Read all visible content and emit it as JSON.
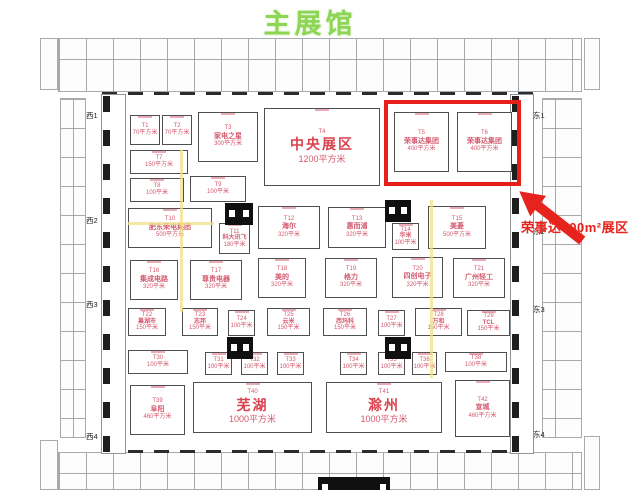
{
  "title": "主展馆",
  "callout": {
    "text": "荣事达800m²展区"
  },
  "colors": {
    "highlight_red": "#e71f19",
    "booth_text_pink": "#d4596e",
    "title_green": "#8ed455"
  },
  "highlighted_booths": [
    "T5",
    "T6"
  ],
  "gates": [
    {
      "label": "西1",
      "x": 86,
      "y": 110
    },
    {
      "label": "西2",
      "x": 86,
      "y": 215
    },
    {
      "label": "西3",
      "x": 86,
      "y": 299
    },
    {
      "label": "西4",
      "x": 86,
      "y": 431
    },
    {
      "label": "东1",
      "x": 533,
      "y": 110
    },
    {
      "label": "东2",
      "x": 533,
      "y": 226
    },
    {
      "label": "东3",
      "x": 533,
      "y": 304
    },
    {
      "label": "东4",
      "x": 533,
      "y": 429
    }
  ],
  "booths": [
    {
      "id": "T1",
      "name": "",
      "area": "70平方米",
      "x": 130,
      "y": 115,
      "w": 30,
      "h": 30,
      "size": "sm"
    },
    {
      "id": "T2",
      "name": "",
      "area": "70平方米",
      "x": 162,
      "y": 115,
      "w": 30,
      "h": 30,
      "size": "sm"
    },
    {
      "id": "T3",
      "name": "家电之星",
      "area": "300平方米",
      "x": 198,
      "y": 112,
      "w": 60,
      "h": 50,
      "size": "md"
    },
    {
      "id": "T4",
      "name": "中央展区",
      "area": "1200平方米",
      "x": 264,
      "y": 108,
      "w": 116,
      "h": 78,
      "size": "lg"
    },
    {
      "id": "T5",
      "name": "荣事达集团",
      "area": "400平方米",
      "x": 394,
      "y": 112,
      "w": 55,
      "h": 60,
      "size": "md"
    },
    {
      "id": "T6",
      "name": "荣事达集团",
      "area": "400平方米",
      "x": 457,
      "y": 112,
      "w": 55,
      "h": 60,
      "size": "md"
    },
    {
      "id": "T7",
      "name": "",
      "area": "150平方米",
      "x": 130,
      "y": 150,
      "w": 58,
      "h": 24,
      "size": "sm"
    },
    {
      "id": "T8",
      "name": "",
      "area": "100平米",
      "x": 130,
      "y": 178,
      "w": 54,
      "h": 24,
      "size": "sm"
    },
    {
      "id": "T9",
      "name": "",
      "area": "100平米",
      "x": 190,
      "y": 176,
      "w": 56,
      "h": 26,
      "size": "sm"
    },
    {
      "id": "T10",
      "name": "肥东荣电集团",
      "area": "500平方米",
      "x": 128,
      "y": 208,
      "w": 84,
      "h": 40,
      "size": "md"
    },
    {
      "id": "T11",
      "name": "科大讯飞",
      "area": "180平米",
      "x": 219,
      "y": 223,
      "w": 31,
      "h": 31,
      "size": "sm"
    },
    {
      "id": "T12",
      "name": "海尔",
      "area": "320平米",
      "x": 258,
      "y": 206,
      "w": 62,
      "h": 43,
      "size": "md"
    },
    {
      "id": "T13",
      "name": "惠而浦",
      "area": "320平米",
      "x": 328,
      "y": 207,
      "w": 58,
      "h": 41,
      "size": "md"
    },
    {
      "id": "T14",
      "name": "华米",
      "area": "100平米",
      "x": 392,
      "y": 223,
      "w": 27,
      "h": 27,
      "size": "sm"
    },
    {
      "id": "T15",
      "name": "美菱",
      "area": "500平方米",
      "x": 428,
      "y": 206,
      "w": 58,
      "h": 43,
      "size": "md"
    },
    {
      "id": "T16",
      "name": "集成电路",
      "area": "320平米",
      "x": 130,
      "y": 260,
      "w": 48,
      "h": 40,
      "size": "md"
    },
    {
      "id": "T17",
      "name": "尊贵电器",
      "area": "320平米",
      "x": 190,
      "y": 260,
      "w": 52,
      "h": 40,
      "size": "md"
    },
    {
      "id": "T18",
      "name": "美的",
      "area": "320平米",
      "x": 258,
      "y": 258,
      "w": 48,
      "h": 40,
      "size": "md"
    },
    {
      "id": "T19",
      "name": "格力",
      "area": "320平米",
      "x": 325,
      "y": 258,
      "w": 52,
      "h": 40,
      "size": "md"
    },
    {
      "id": "T20",
      "name": "四创电子",
      "area": "320平米",
      "x": 392,
      "y": 257,
      "w": 51,
      "h": 41,
      "size": "md"
    },
    {
      "id": "T21",
      "name": "广州轻工",
      "area": "320平米",
      "x": 453,
      "y": 258,
      "w": 52,
      "h": 40,
      "size": "md"
    },
    {
      "id": "T22",
      "name": "巢湖市",
      "area": "150平米",
      "x": 128,
      "y": 308,
      "w": 38,
      "h": 28,
      "size": "sm"
    },
    {
      "id": "T23",
      "name": "志邦",
      "area": "150平米",
      "x": 182,
      "y": 308,
      "w": 36,
      "h": 28,
      "size": "sm"
    },
    {
      "id": "T24",
      "name": "",
      "area": "100平米",
      "x": 228,
      "y": 310,
      "w": 27,
      "h": 26,
      "size": "sm"
    },
    {
      "id": "T25",
      "name": "云米",
      "area": "150平米",
      "x": 267,
      "y": 308,
      "w": 43,
      "h": 28,
      "size": "sm"
    },
    {
      "id": "T26",
      "name": "西玛科",
      "area": "150平米",
      "x": 323,
      "y": 308,
      "w": 44,
      "h": 28,
      "size": "sm"
    },
    {
      "id": "T27",
      "name": "",
      "area": "100平米",
      "x": 378,
      "y": 310,
      "w": 27,
      "h": 26,
      "size": "sm"
    },
    {
      "id": "T28",
      "name": "万和",
      "area": "150平米",
      "x": 415,
      "y": 308,
      "w": 47,
      "h": 28,
      "size": "sm"
    },
    {
      "id": "T29",
      "name": "TCL",
      "area": "150平米",
      "x": 467,
      "y": 310,
      "w": 43,
      "h": 26,
      "size": "sm"
    },
    {
      "id": "T30",
      "name": "",
      "area": "100平米",
      "x": 128,
      "y": 350,
      "w": 60,
      "h": 24,
      "size": "sm"
    },
    {
      "id": "T31",
      "name": "",
      "area": "100平米",
      "x": 205,
      "y": 352,
      "w": 27,
      "h": 23,
      "size": "sm"
    },
    {
      "id": "T32",
      "name": "",
      "area": "100平米",
      "x": 241,
      "y": 352,
      "w": 27,
      "h": 23,
      "size": "sm"
    },
    {
      "id": "T33",
      "name": "",
      "area": "100平米",
      "x": 277,
      "y": 352,
      "w": 27,
      "h": 23,
      "size": "sm"
    },
    {
      "id": "T34",
      "name": "",
      "area": "100平米",
      "x": 340,
      "y": 352,
      "w": 27,
      "h": 23,
      "size": "sm"
    },
    {
      "id": "T35",
      "name": "",
      "area": "100平米",
      "x": 378,
      "y": 352,
      "w": 27,
      "h": 23,
      "size": "sm"
    },
    {
      "id": "T36",
      "name": "",
      "area": "100平米",
      "x": 412,
      "y": 352,
      "w": 25,
      "h": 23,
      "size": "sm"
    },
    {
      "id": "T38",
      "name": "",
      "area": "100平米",
      "x": 445,
      "y": 352,
      "w": 62,
      "h": 20,
      "size": "sm"
    },
    {
      "id": "T39",
      "name": "阜阳",
      "area": "460平方米",
      "x": 130,
      "y": 385,
      "w": 55,
      "h": 50,
      "size": "md"
    },
    {
      "id": "T40",
      "name": "芜湖",
      "area": "1000平方米",
      "x": 193,
      "y": 382,
      "w": 119,
      "h": 51,
      "size": "lg"
    },
    {
      "id": "T41",
      "name": "滁州",
      "area": "1000平方米",
      "x": 326,
      "y": 382,
      "w": 116,
      "h": 51,
      "size": "lg"
    },
    {
      "id": "T42",
      "name": "宣城",
      "area": "460平方米",
      "x": 455,
      "y": 380,
      "w": 55,
      "h": 57,
      "size": "md"
    }
  ]
}
